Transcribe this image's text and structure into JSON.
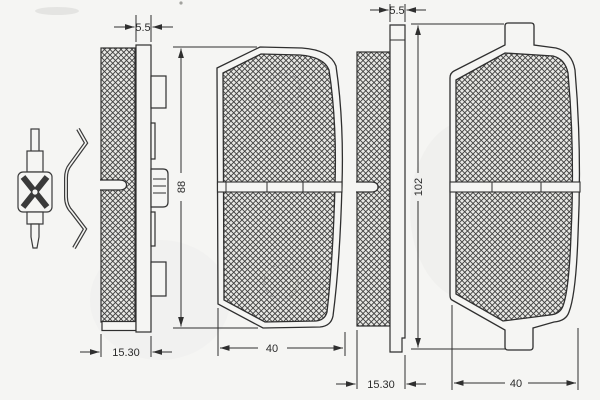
{
  "drawing": {
    "labels": {
      "left_plate_thickness": "5.5",
      "right_plate_thickness": "5.5",
      "left_pad_height": "88",
      "right_pad_height": "102",
      "left_assembly_thickness": "15.30",
      "right_assembly_thickness": "15.30",
      "left_friction_width": "40",
      "right_friction_width": "40"
    },
    "parts": [
      "wear-indicator-clip",
      "spring-clip",
      "left-pad-side-view",
      "left-pad-front-view",
      "right-pad-side-view",
      "right-pad-front-view"
    ],
    "colors": {
      "line": "#2f2f2f",
      "background": "#f5f5f3",
      "hatch_background": "#e7e7e4",
      "hatch_line": "#3f3f3f"
    }
  }
}
